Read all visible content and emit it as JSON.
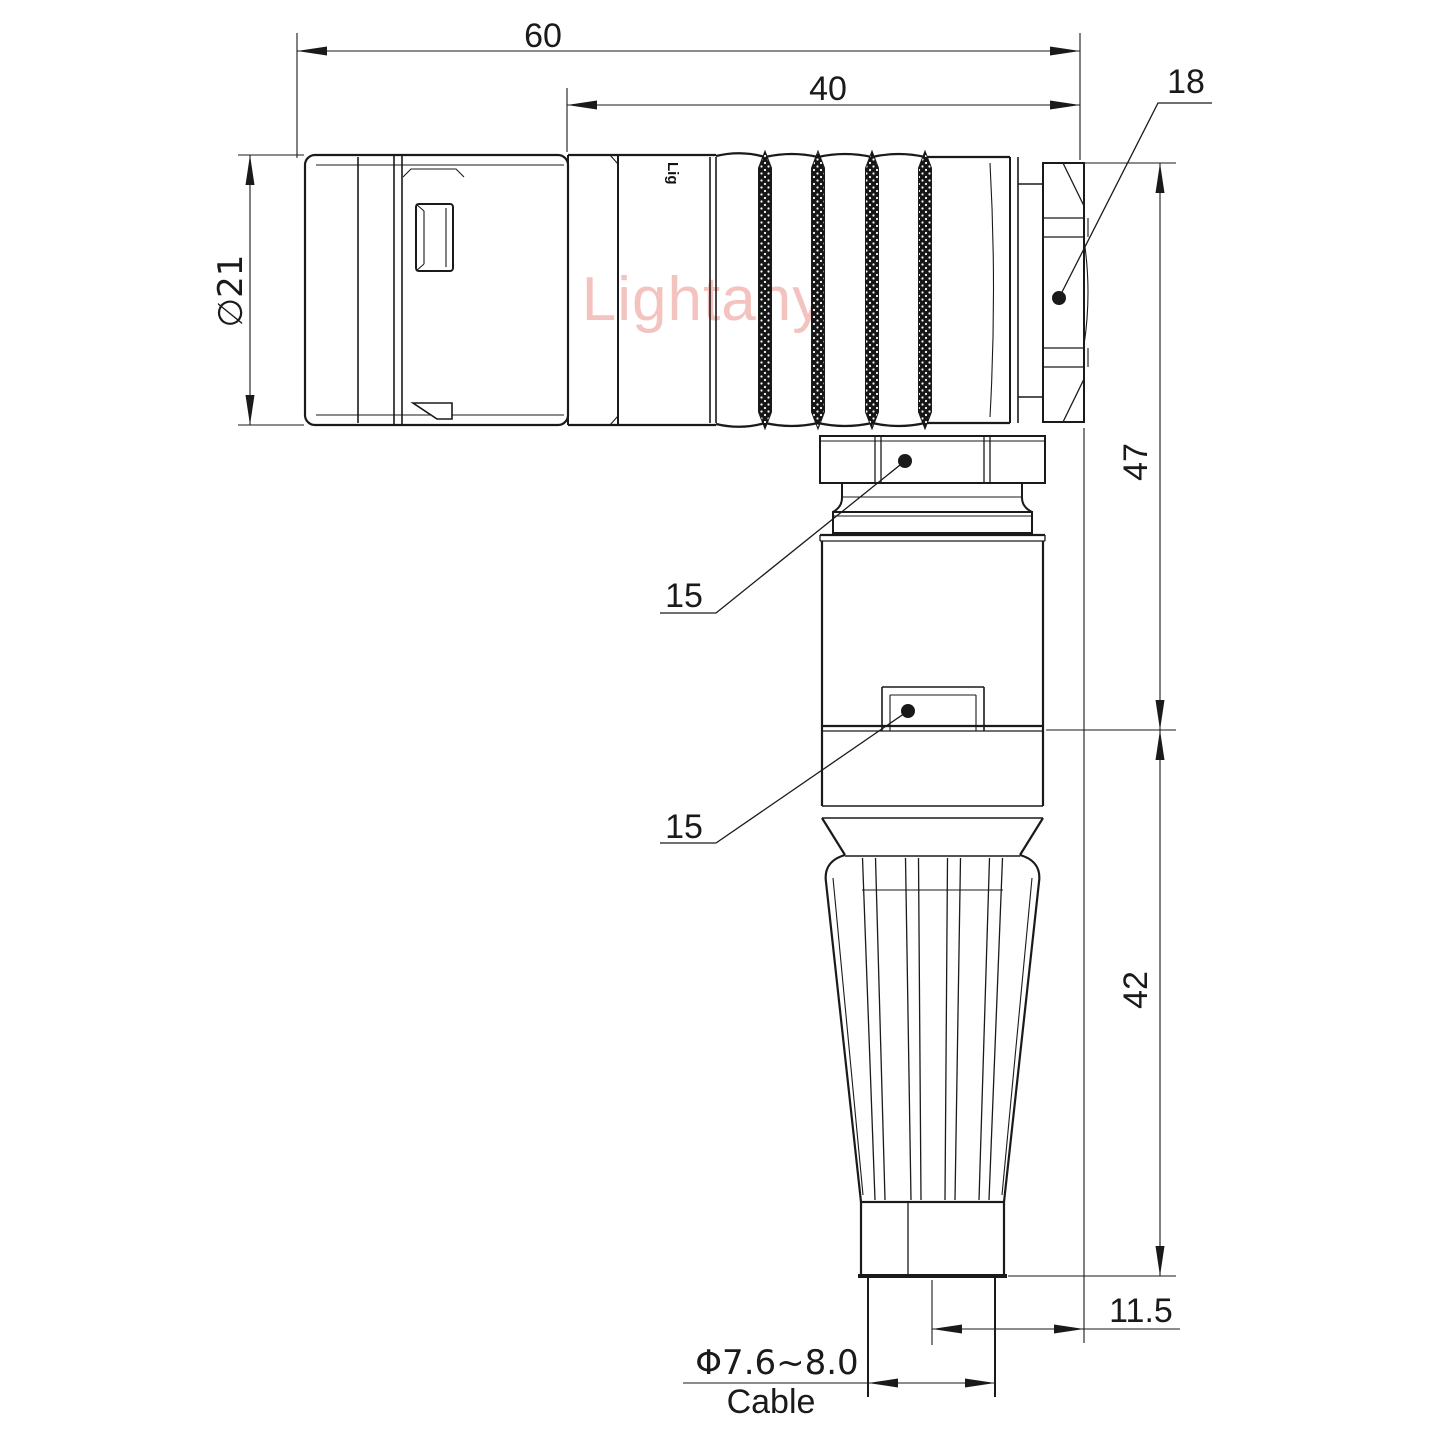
{
  "watermark": {
    "text": "Lightany",
    "color": "#f2b9b5"
  },
  "engraving": {
    "text": "Lig"
  },
  "dimensions": {
    "overall_length": "60",
    "rear_length": "40",
    "nut_across_flats": "18",
    "plug_diameter": "∅21",
    "upper_height": "47",
    "lower_height": "42",
    "axis_offset": "11.5",
    "coupling_nut_flats": "15",
    "body_nut_flats": "15",
    "cable_diameter": "Φ7.6~8.0",
    "cable_label": "Cable"
  },
  "colors": {
    "line": "#1a1a1a",
    "background": "#ffffff",
    "watermark": "#f2b9b5"
  }
}
